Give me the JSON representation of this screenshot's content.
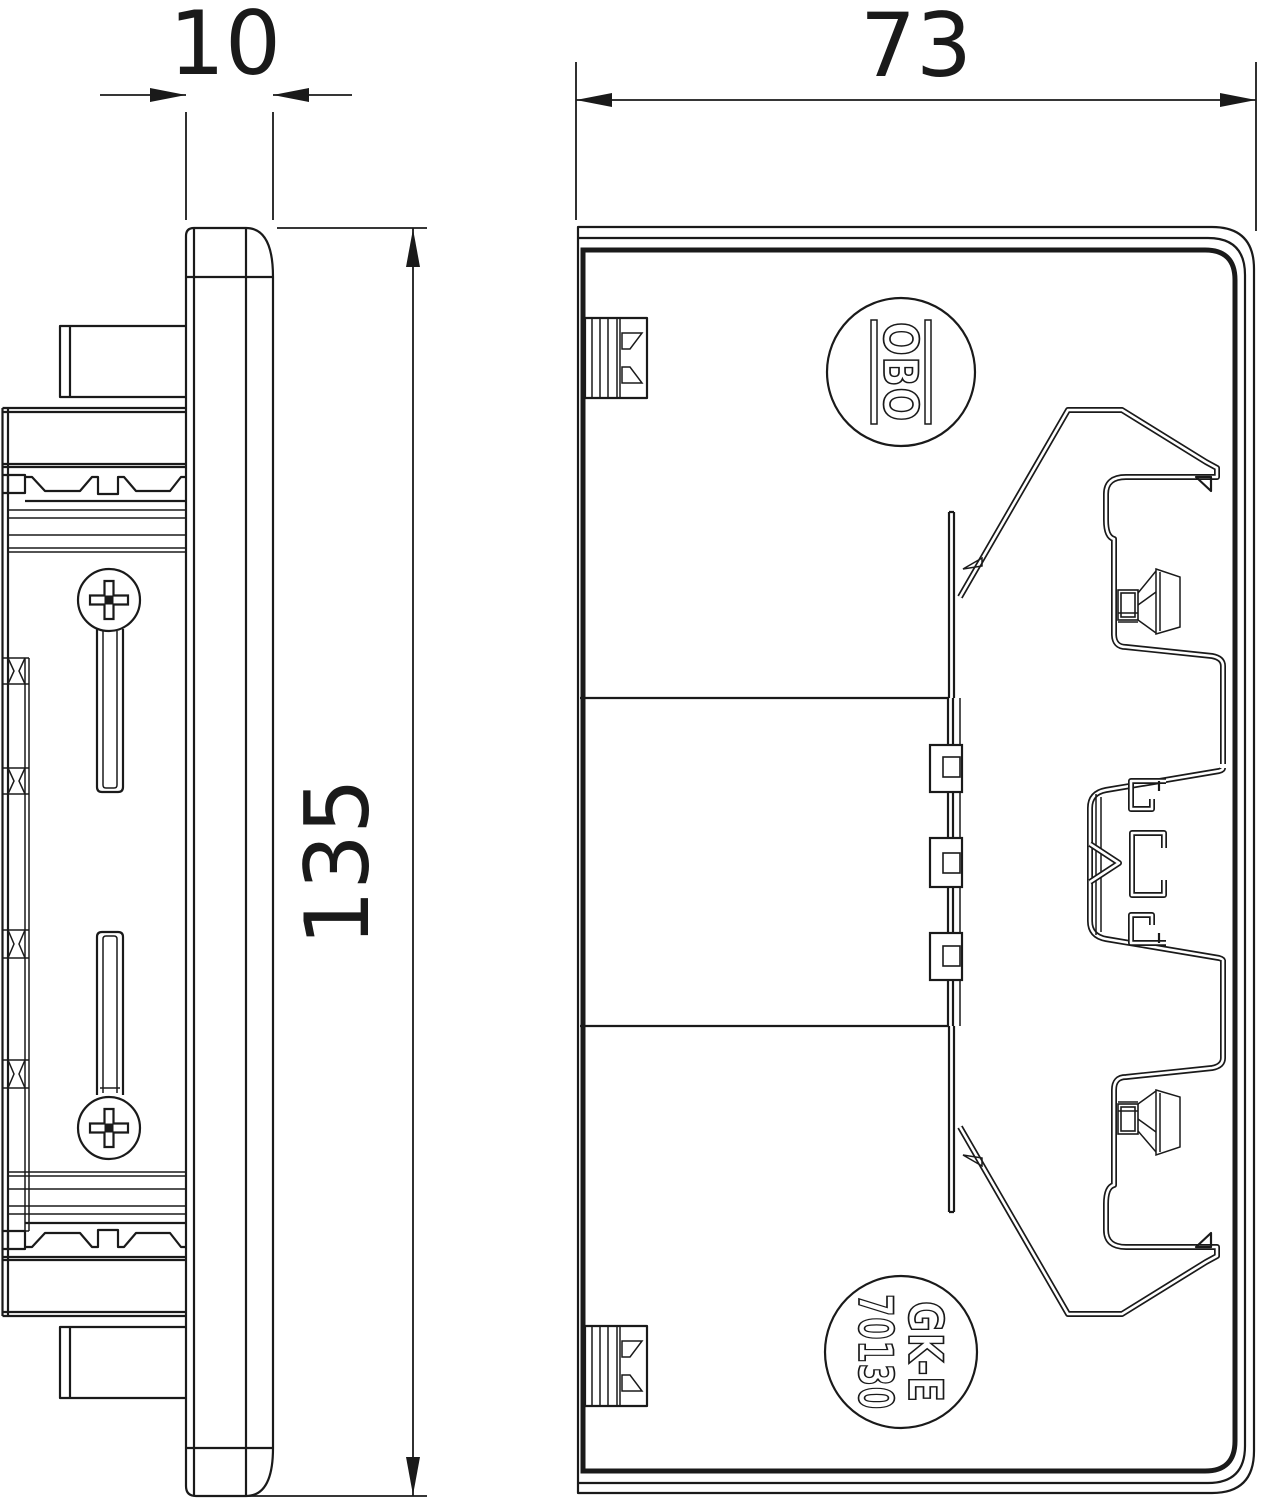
{
  "colors": {
    "line": "#1a1a1a",
    "background": "#ffffff"
  },
  "dimensions": {
    "side_width": "10",
    "front_width": "73",
    "height": "135"
  },
  "stamps": {
    "brand": "OBO",
    "product_line1": "GK-E",
    "product_line2": "70130"
  }
}
